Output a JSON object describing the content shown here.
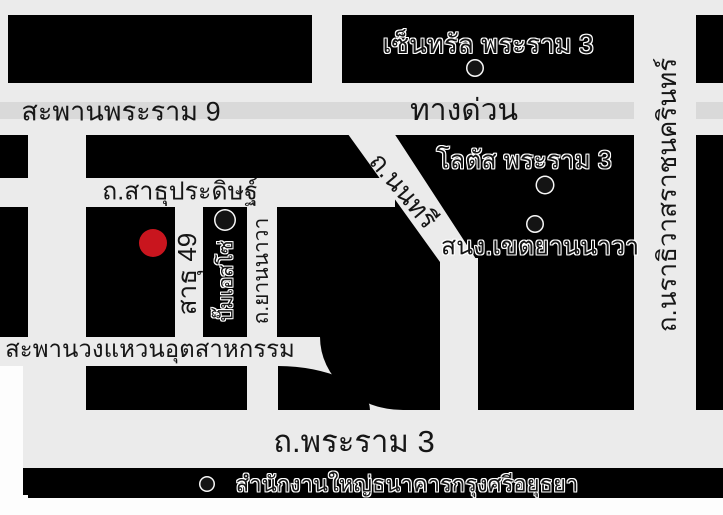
{
  "map": {
    "colors": {
      "background": "#000000",
      "road": "#ebebeb",
      "road_divider": "#d9d9d9",
      "marker": "#c9151e",
      "label_text": "#161616"
    },
    "roads": {
      "rama9_bridge": "สะพานพระราม 9",
      "expressway": "ทางด่วน",
      "narathiwat_rd": "ถ.นราธิวาสราชนครินทร์",
      "nonsee_rd": "ถ.นนทรี",
      "sathupradit_rd": "ถ.สาธุประดิษฐ์",
      "sathu_49": "สาธุ 49",
      "yannawa_rd": "ถ.ยานนาวา",
      "industrial_ring_bridge": "สะพานวงแหวนอุตสาหกรรม",
      "rama3_rd": "ถ.พระราม 3"
    },
    "pois": {
      "central_rama3": "เซ็นทรัล พระราม 3",
      "lotus_rama3": "โลตัส พระราม 3",
      "yannawa_district_office": "สนง.เขตยานนาวา",
      "esso_station": "ปั๊มเอสโซ่",
      "krungsri_bank_hq": "สำนักงานใหญ่ธนาคารกรุงศรีอยุธยา"
    }
  }
}
